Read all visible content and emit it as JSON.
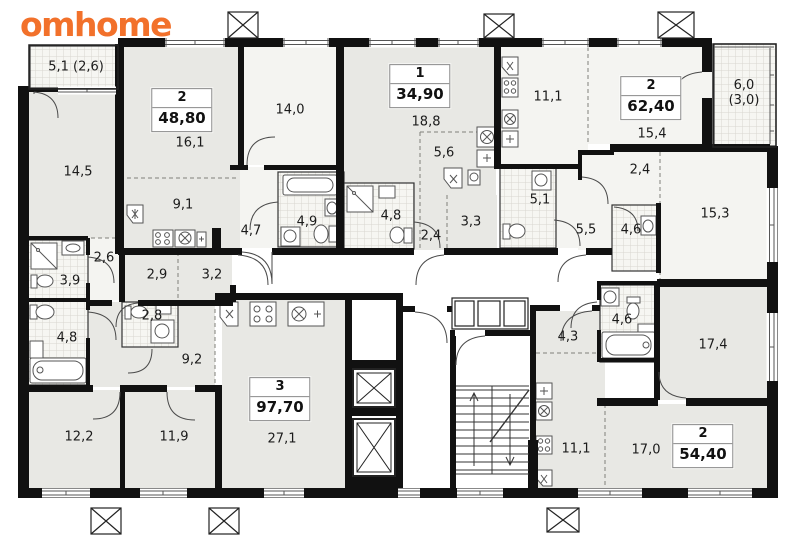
{
  "brand": {
    "logo_text": "omhome",
    "logo_color": "#f2712b"
  },
  "colors": {
    "walls": "#111111",
    "room_fill_gray": "#e8e8e4",
    "room_fill_light": "#f4f4f1",
    "corridor_fill": "#ffffff",
    "hatch_line": "#d8d6d0"
  },
  "apartments": [
    {
      "rooms": "2",
      "area": "48,80"
    },
    {
      "rooms": "1",
      "area": "34,90"
    },
    {
      "rooms": "2",
      "area": "62,40"
    },
    {
      "rooms": "3",
      "area": "97,70"
    },
    {
      "rooms": "2",
      "area": "54,40"
    }
  ],
  "room_labels": [
    {
      "text": "5,1 (2,6)"
    },
    {
      "text": "14,5"
    },
    {
      "text": "16,1"
    },
    {
      "text": "9,1"
    },
    {
      "text": "14,0"
    },
    {
      "text": "4,7"
    },
    {
      "text": "4,9"
    },
    {
      "text": "18,8"
    },
    {
      "text": "5,6"
    },
    {
      "text": "4,8"
    },
    {
      "text": "2,4"
    },
    {
      "text": "3,3"
    },
    {
      "text": "11,1"
    },
    {
      "text": "5,1"
    },
    {
      "text": "5,5"
    },
    {
      "text": "15,4"
    },
    {
      "text": "2,4"
    },
    {
      "text": "4,6"
    },
    {
      "text": "15,3"
    },
    {
      "text": "6,0 (3,0)"
    },
    {
      "text": "2,6"
    },
    {
      "text": "2,9"
    },
    {
      "text": "3,2"
    },
    {
      "text": "3,9"
    },
    {
      "text": "4,8"
    },
    {
      "text": "2,8"
    },
    {
      "text": "9,2"
    },
    {
      "text": "12,2"
    },
    {
      "text": "11,9"
    },
    {
      "text": "27,1"
    },
    {
      "text": "4,3"
    },
    {
      "text": "4,6"
    },
    {
      "text": "17,4"
    },
    {
      "text": "11,1"
    },
    {
      "text": "17,0"
    }
  ]
}
